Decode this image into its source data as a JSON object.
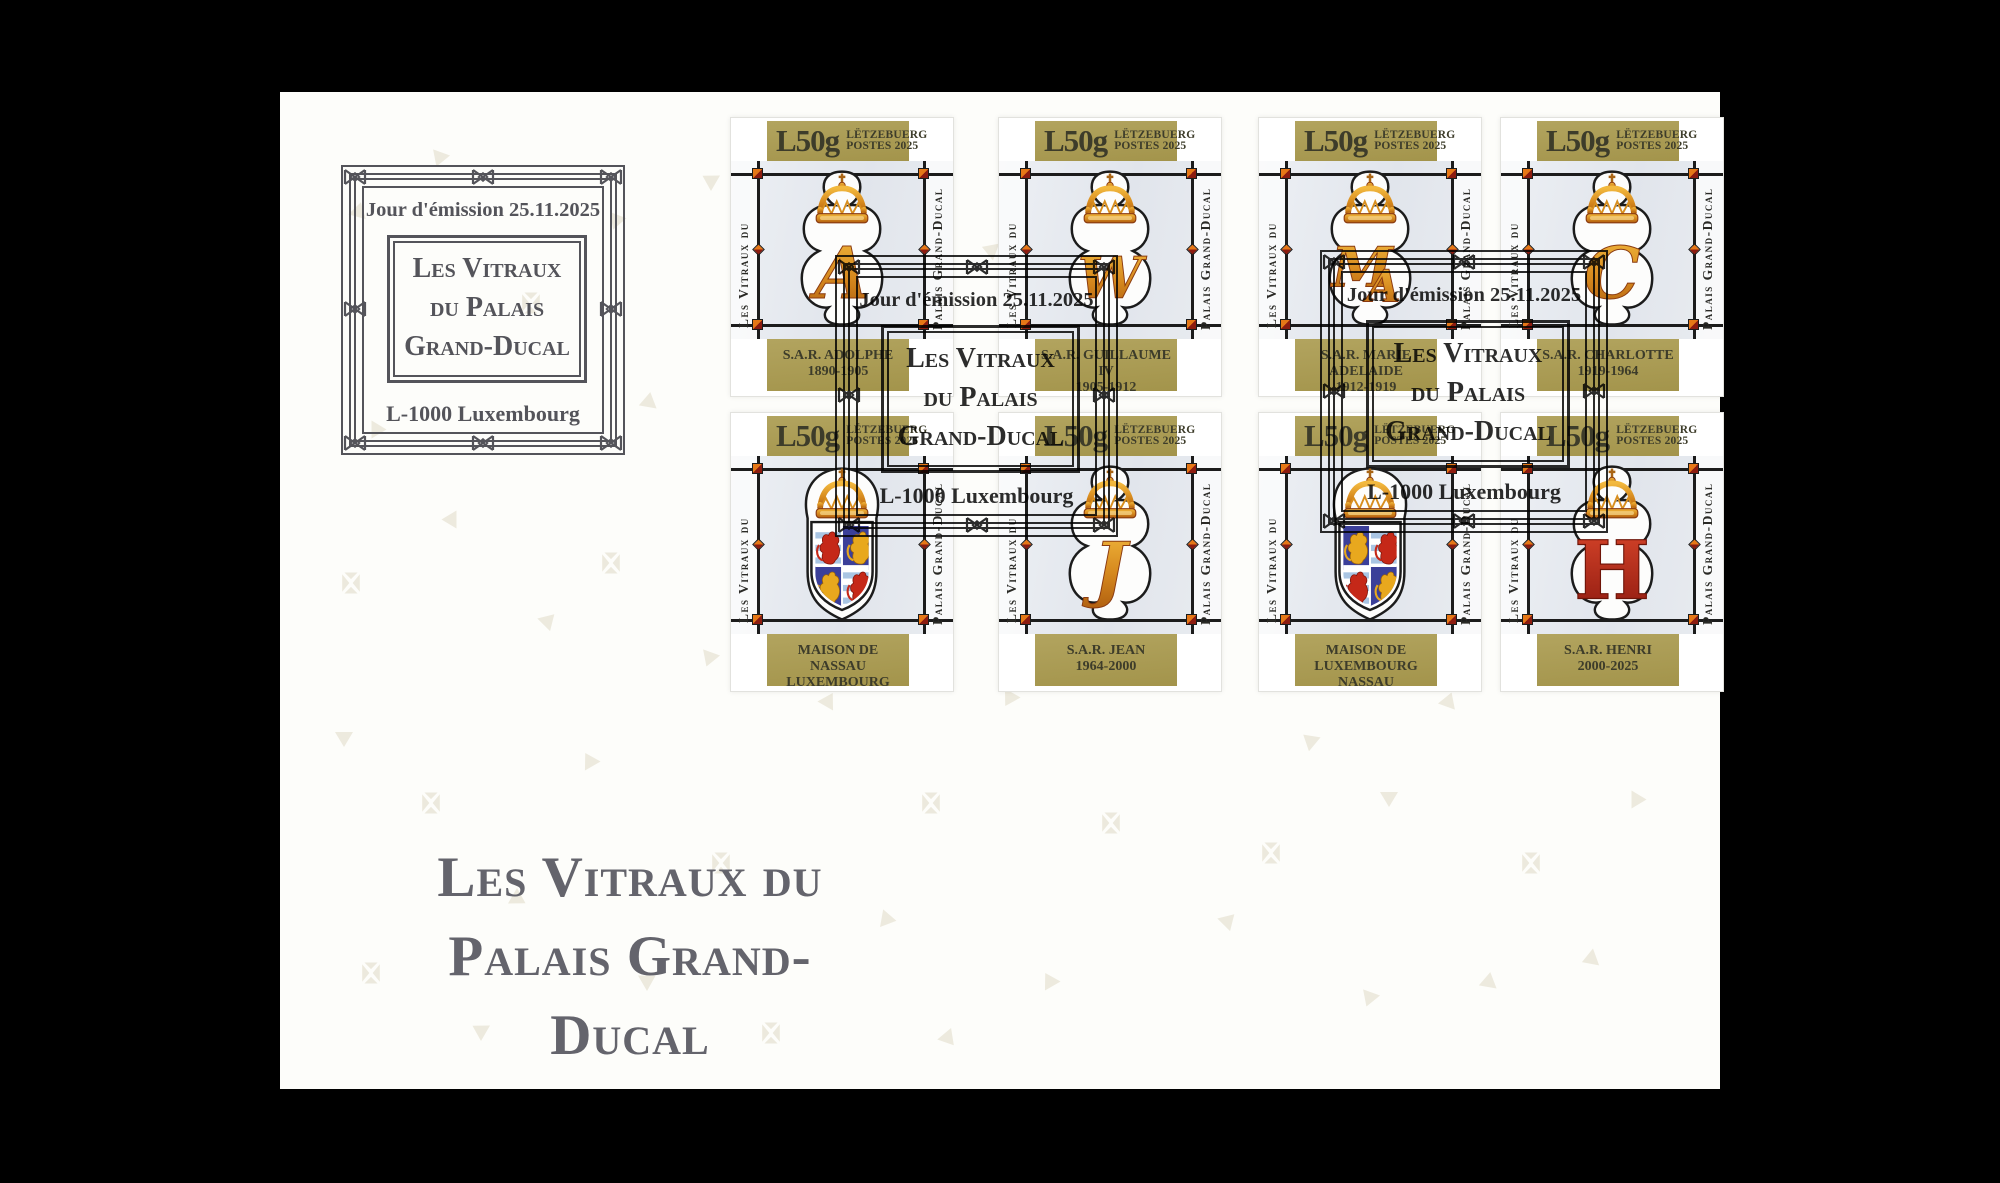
{
  "cachet": {
    "issue_line": "Jour d'émission 25.11.2025",
    "box_line1": "Les Vitraux",
    "box_line2": "du Palais",
    "box_line3": "Grand-Ducal",
    "city_line": "L-1000 Luxembourg"
  },
  "stamp_common": {
    "denomination": "L50g",
    "country": "LËTZEBUERG",
    "issue": "POSTES 2025",
    "side_left": "Les Vitraux du",
    "side_right": "Palais Grand-Ducal"
  },
  "stamps": [
    {
      "name": "S.A.R. ADOLPHE",
      "dates": "1890-1905",
      "motif": "monogram",
      "monogram": "A"
    },
    {
      "name": "S.A.R. GUILLAUME IV",
      "dates": "1905-1912",
      "motif": "monogram",
      "monogram": "W"
    },
    {
      "name": "S.A.R. MARIE ADELAIDE",
      "dates": "1912-1919",
      "motif": "monogram",
      "monogram": "MA"
    },
    {
      "name": "S.A.R. CHARLOTTE",
      "dates": "1919-1964",
      "motif": "monogram",
      "monogram": "C"
    },
    {
      "name": "MAISON DE",
      "dates": "NASSAU LUXEMBOURG",
      "motif": "arms",
      "arms": "nassau-luxembourg"
    },
    {
      "name": "S.A.R. JEAN",
      "dates": "1964-2000",
      "motif": "monogram",
      "monogram": "J"
    },
    {
      "name": "MAISON DE",
      "dates": "LUXEMBOURG NASSAU",
      "motif": "arms",
      "arms": "luxembourg-nassau"
    },
    {
      "name": "S.A.R. HENRI",
      "dates": "2000-2025",
      "motif": "monogram",
      "monogram": "H",
      "monogram_style": "red"
    }
  ],
  "title": {
    "line1": "Les Vitraux du",
    "line2": "Palais Grand-Ducal"
  },
  "colors": {
    "background": "#000000",
    "envelope": "#fdfdfa",
    "gold_band": "#a89a52",
    "band_text": "#3d3c2a",
    "lead_line": "#1c1c1c",
    "cachet_ink": "#54545a",
    "postmark_ink": "#1c1c1c",
    "monogram_gold": "#d6891e",
    "monogram_red": "#bb3018",
    "accent_orange": "#e67817",
    "accent_dark_red": "#8c1c10",
    "title_text": "#64646c",
    "decor": "#eae6d8",
    "glass": "#e8ecf1"
  }
}
